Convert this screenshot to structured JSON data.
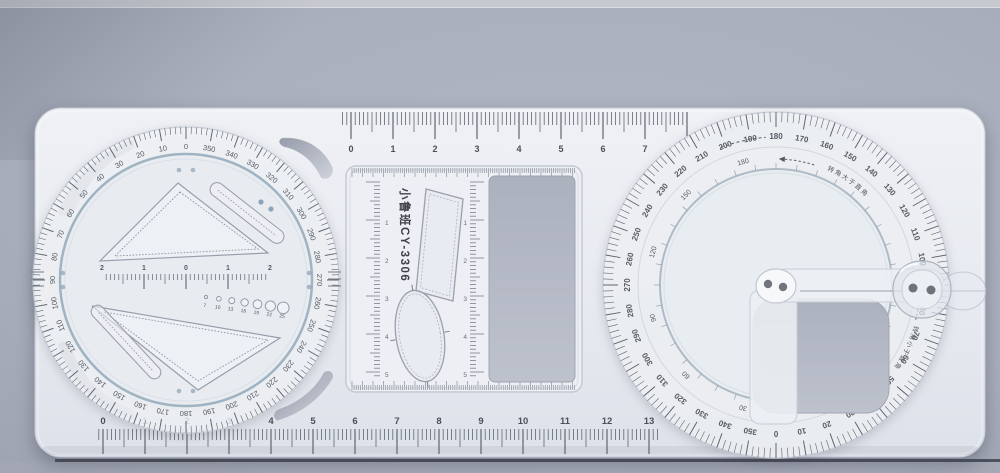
{
  "background": {
    "top_strip": "#c6c9cf",
    "main": "#a9aebc",
    "table_line": "#41444d",
    "lower": "#a6aab5"
  },
  "base_plate": {
    "color": "#e9ecf2"
  },
  "top_ruler": {
    "labels": [
      "0",
      "1",
      "2",
      "3",
      "4",
      "5",
      "6",
      "7"
    ]
  },
  "bottom_ruler": {
    "labels": [
      "0",
      "1",
      "2",
      "3",
      "4",
      "5",
      "6",
      "7",
      "8",
      "9",
      "10",
      "11",
      "12",
      "13"
    ]
  },
  "stencil_frame": {
    "brand_text": "小鲁班CY-3306",
    "left_ruler_labels": [
      "1",
      "2",
      "3",
      "4",
      "5"
    ],
    "center_ruler_labels": [
      "1",
      "2",
      "3",
      "4",
      "5"
    ]
  },
  "left_dial": {
    "degree_labels": [
      "0",
      "10",
      "20",
      "30",
      "40",
      "50",
      "60",
      "70",
      "80",
      "90",
      "100",
      "110",
      "120",
      "130",
      "140",
      "150",
      "160",
      "170",
      "180",
      "190",
      "200",
      "210",
      "220",
      "230",
      "240",
      "250",
      "260",
      "270",
      "280",
      "290",
      "300",
      "310",
      "320",
      "330",
      "340",
      "350"
    ],
    "center_ruler_labels": [
      "2",
      "1",
      "0",
      "1",
      "2"
    ],
    "circle_template_labels": [
      "7",
      "10",
      "13",
      "16",
      "19",
      "22",
      "25"
    ]
  },
  "right_protractor": {
    "outer_degree_labels": [
      "0",
      "10",
      "20",
      "30",
      "40",
      "50",
      "60",
      "70",
      "80",
      "90",
      "100",
      "110",
      "120",
      "130",
      "140",
      "150",
      "160",
      "170",
      "180",
      "190",
      "200",
      "210",
      "220",
      "230",
      "240",
      "250",
      "260",
      "270",
      "280",
      "290",
      "300",
      "310",
      "320",
      "330",
      "340",
      "350"
    ],
    "inner_degree_labels": [
      "30",
      "60",
      "90",
      "120",
      "150",
      "180"
    ],
    "arc_note_top": "转角大于直角",
    "arc_note_bottom": "转角小于直角"
  }
}
